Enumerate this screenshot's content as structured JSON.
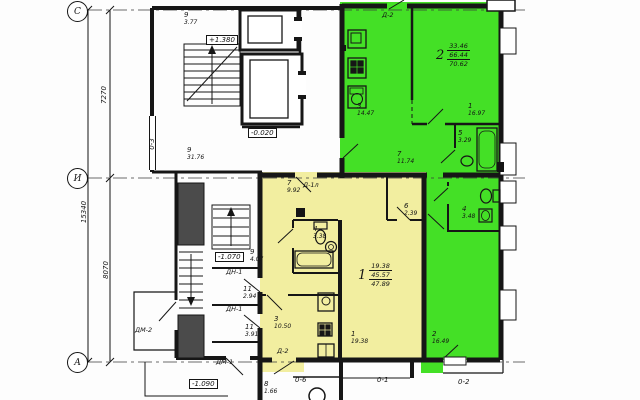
{
  "colors": {
    "apt1": "#f2eea0",
    "apt2": "#44e026"
  },
  "axes": {
    "row_c": "С",
    "row_i": "И",
    "row_a": "А",
    "col_left": "0-3",
    "cols": [
      {
        "label": "0-6"
      },
      {
        "label": "0-1"
      },
      {
        "label": "0-2"
      }
    ]
  },
  "dims": {
    "c_i": "7270",
    "i_a": "8070",
    "total": "15340"
  },
  "levels": {
    "stair": "+1.380",
    "ground": "-0.020",
    "entry": "-1.070",
    "porch": "-1.090"
  },
  "doors": {
    "balcony_top": "Д-2",
    "apt1_entry": "Д-1л",
    "apt1_balcony": "Д-2",
    "inner1": "ДН-1",
    "inner2": "ДН-1",
    "main": "ДМ-1",
    "side": "ДМ-2"
  },
  "common": {
    "stair_top": {
      "num": "9",
      "area": "3.77"
    },
    "stair_main": {
      "num": "9",
      "area": "31.76"
    },
    "lobby": {
      "num": "9",
      "area": "4.07"
    },
    "vestibule1": {
      "num": "11",
      "area": "2.94"
    },
    "vestibule2": {
      "num": "11",
      "area": "3.91"
    },
    "tambour": {
      "num": "8",
      "area": "1.66"
    }
  },
  "apt1": {
    "number": "1",
    "living": "19.38",
    "usable": "45.57",
    "total": "47.89",
    "rooms": {
      "hall": {
        "num": "7",
        "area": "9.92"
      },
      "bath": {
        "num": "4",
        "area": "3.38"
      },
      "closet": {
        "num": "6",
        "area": "2.39"
      },
      "kitchen": {
        "num": "3",
        "area": "10.50"
      },
      "living": {
        "num": "1",
        "area": "19.38"
      }
    }
  },
  "apt2": {
    "number": "2",
    "living": "33.46",
    "usable": "66.44",
    "total": "70.62",
    "rooms": {
      "kitchen": {
        "num": "3",
        "area": "14.47"
      },
      "living": {
        "num": "1",
        "area": "16.97"
      },
      "bath": {
        "num": "5",
        "area": "3.29"
      },
      "hall": {
        "num": "7",
        "area": "11.74"
      },
      "wc": {
        "num": "4",
        "area": "3.48"
      },
      "bedroom": {
        "num": "2",
        "area": "16.49"
      }
    }
  }
}
